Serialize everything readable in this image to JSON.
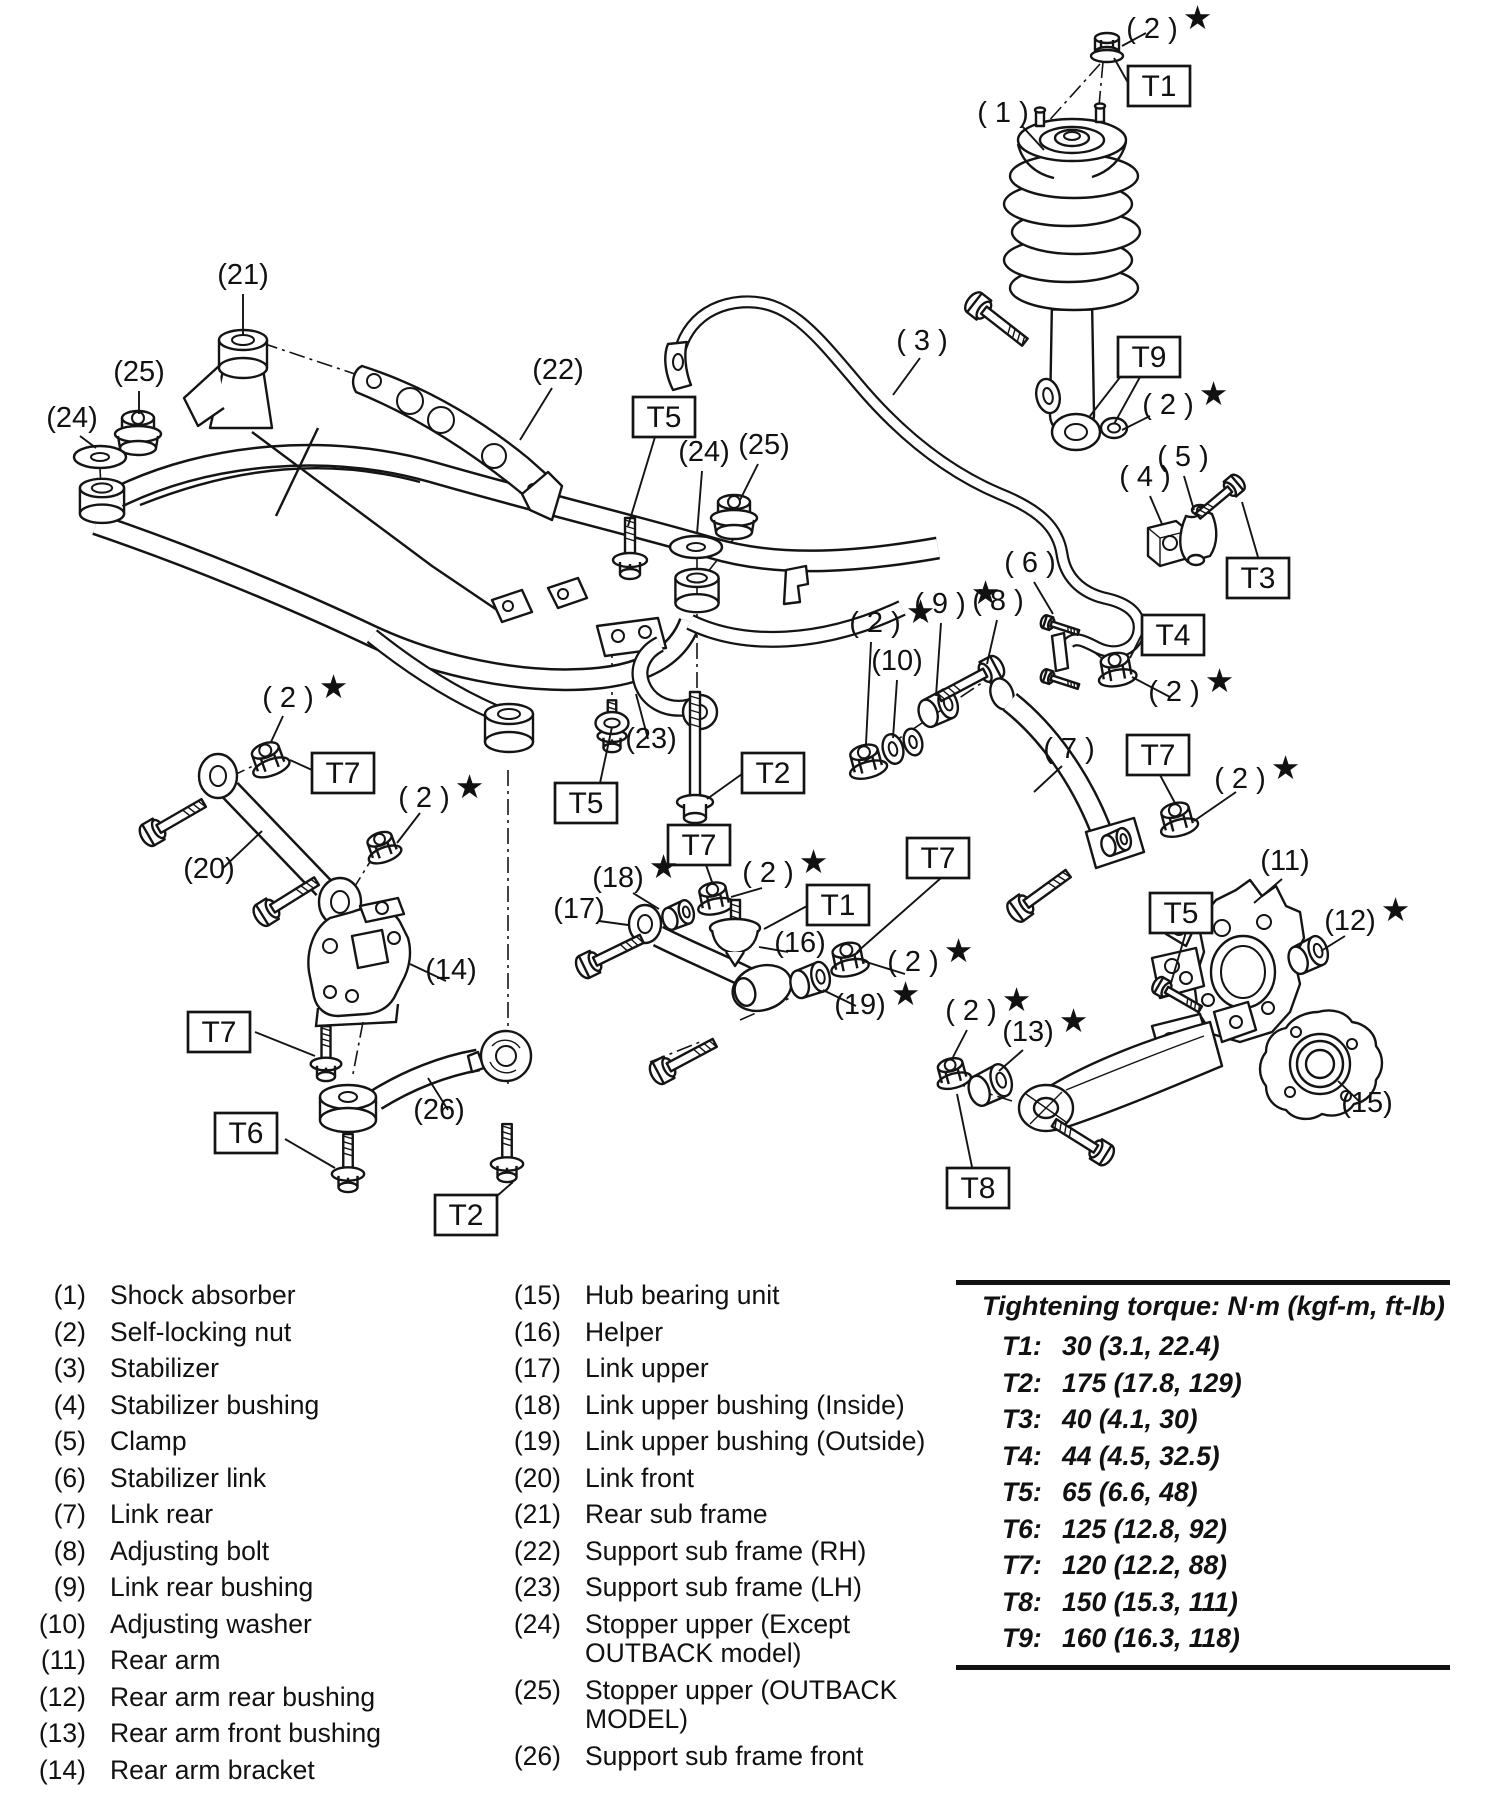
{
  "diagram": {
    "star": "★",
    "callouts": [
      {
        "t": "( 2 )",
        "x": 1152,
        "y": 38,
        "s": true
      },
      {
        "t": "( 1 )",
        "x": 1003,
        "y": 122,
        "s": false
      },
      {
        "t": "( 3 )",
        "x": 922,
        "y": 350,
        "s": false
      },
      {
        "t": "( 2 )",
        "x": 1168,
        "y": 414,
        "s": true
      },
      {
        "t": "(21)",
        "x": 243,
        "y": 284,
        "s": false
      },
      {
        "t": "(25)",
        "x": 139,
        "y": 381,
        "s": false
      },
      {
        "t": "(24)",
        "x": 72,
        "y": 427,
        "s": false
      },
      {
        "t": "(22)",
        "x": 558,
        "y": 379,
        "s": false
      },
      {
        "t": "(24)",
        "x": 704,
        "y": 461,
        "s": false
      },
      {
        "t": "(25)",
        "x": 764,
        "y": 454,
        "s": false
      },
      {
        "t": "( 4 )",
        "x": 1145,
        "y": 486,
        "s": false
      },
      {
        "t": "( 5 )",
        "x": 1183,
        "y": 466,
        "s": false
      },
      {
        "t": "( 6 )",
        "x": 1030,
        "y": 572,
        "s": false
      },
      {
        "t": "( 9 )",
        "x": 940,
        "y": 613,
        "s": true
      },
      {
        "t": "( 8 )",
        "x": 998,
        "y": 610,
        "s": false
      },
      {
        "t": "( 2 )",
        "x": 875,
        "y": 632,
        "s": true
      },
      {
        "t": "(10)",
        "x": 897,
        "y": 670,
        "s": false
      },
      {
        "t": "( 2 )",
        "x": 1174,
        "y": 701,
        "s": true
      },
      {
        "t": "( 7 )",
        "x": 1069,
        "y": 758,
        "s": false
      },
      {
        "t": "( 2 )",
        "x": 1240,
        "y": 788,
        "s": true
      },
      {
        "t": "( 2 )",
        "x": 288,
        "y": 707,
        "s": true
      },
      {
        "t": "( 2 )",
        "x": 424,
        "y": 807,
        "s": true
      },
      {
        "t": "(20)",
        "x": 209,
        "y": 878,
        "s": false
      },
      {
        "t": "(23)",
        "x": 651,
        "y": 748,
        "s": false
      },
      {
        "t": "(18)",
        "x": 618,
        "y": 887,
        "s": true
      },
      {
        "t": "( 2 )",
        "x": 768,
        "y": 882,
        "s": true
      },
      {
        "t": "(17)",
        "x": 579,
        "y": 918,
        "s": false
      },
      {
        "t": "(16)",
        "x": 800,
        "y": 952,
        "s": false
      },
      {
        "t": "( 2 )",
        "x": 913,
        "y": 971,
        "s": true
      },
      {
        "t": "(19)",
        "x": 860,
        "y": 1014,
        "s": true
      },
      {
        "t": "(11)",
        "x": 1285,
        "y": 870,
        "s": false
      },
      {
        "t": "(12)",
        "x": 1350,
        "y": 930,
        "s": true
      },
      {
        "t": "(14)",
        "x": 451,
        "y": 979,
        "s": false
      },
      {
        "t": "( 2 )",
        "x": 971,
        "y": 1020,
        "s": true
      },
      {
        "t": "(13)",
        "x": 1028,
        "y": 1041,
        "s": true
      },
      {
        "t": "(15)",
        "x": 1367,
        "y": 1112,
        "s": false
      },
      {
        "t": "(26)",
        "x": 439,
        "y": 1119,
        "s": false
      }
    ],
    "torque_boxes": [
      {
        "label": "T1",
        "x": 1128,
        "y": 66
      },
      {
        "label": "T9",
        "x": 1118,
        "y": 337
      },
      {
        "label": "T5",
        "x": 633,
        "y": 397
      },
      {
        "label": "T3",
        "x": 1227,
        "y": 558
      },
      {
        "label": "T4",
        "x": 1142,
        "y": 615
      },
      {
        "label": "T7",
        "x": 1127,
        "y": 735
      },
      {
        "label": "T7",
        "x": 312,
        "y": 753
      },
      {
        "label": "T5",
        "x": 555,
        "y": 783
      },
      {
        "label": "T2",
        "x": 742,
        "y": 753
      },
      {
        "label": "T7",
        "x": 668,
        "y": 825
      },
      {
        "label": "T1",
        "x": 807,
        "y": 885
      },
      {
        "label": "T7",
        "x": 907,
        "y": 838
      },
      {
        "label": "T5",
        "x": 1150,
        "y": 893
      },
      {
        "label": "T7",
        "x": 188,
        "y": 1012
      },
      {
        "label": "T6",
        "x": 215,
        "y": 1113
      },
      {
        "label": "T2",
        "x": 435,
        "y": 1195
      },
      {
        "label": "T8",
        "x": 947,
        "y": 1168
      }
    ]
  },
  "legend": {
    "left": [
      {
        "num": "(1)",
        "label": "Shock absorber"
      },
      {
        "num": "(2)",
        "label": "Self-locking nut"
      },
      {
        "num": "(3)",
        "label": "Stabilizer"
      },
      {
        "num": "(4)",
        "label": "Stabilizer bushing"
      },
      {
        "num": "(5)",
        "label": "Clamp"
      },
      {
        "num": "(6)",
        "label": "Stabilizer link"
      },
      {
        "num": "(7)",
        "label": "Link rear"
      },
      {
        "num": "(8)",
        "label": "Adjusting bolt"
      },
      {
        "num": "(9)",
        "label": "Link rear bushing"
      },
      {
        "num": "(10)",
        "label": "Adjusting washer"
      },
      {
        "num": "(11)",
        "label": "Rear arm"
      },
      {
        "num": "(12)",
        "label": "Rear arm rear bushing"
      },
      {
        "num": "(13)",
        "label": "Rear arm front bushing"
      },
      {
        "num": "(14)",
        "label": "Rear arm bracket"
      }
    ],
    "right": [
      {
        "num": "(15)",
        "label": "Hub bearing unit"
      },
      {
        "num": "(16)",
        "label": "Helper"
      },
      {
        "num": "(17)",
        "label": "Link upper"
      },
      {
        "num": "(18)",
        "label": "Link upper bushing (Inside)"
      },
      {
        "num": "(19)",
        "label": "Link upper bushing (Outside)"
      },
      {
        "num": "(20)",
        "label": "Link front"
      },
      {
        "num": "(21)",
        "label": "Rear sub frame"
      },
      {
        "num": "(22)",
        "label": "Support sub frame (RH)"
      },
      {
        "num": "(23)",
        "label": "Support sub frame (LH)"
      },
      {
        "num": "(24)",
        "label": "Stopper upper (Except OUTBACK model)"
      },
      {
        "num": "(25)",
        "label": "Stopper upper (OUTBACK MODEL)"
      },
      {
        "num": "(26)",
        "label": "Support sub frame front"
      }
    ]
  },
  "torque_table": {
    "title": "Tightening torque: N·m (kgf-m, ft-lb)",
    "rows": [
      {
        "id": "T1:",
        "value": "30 (3.1, 22.4)"
      },
      {
        "id": "T2:",
        "value": "175 (17.8, 129)"
      },
      {
        "id": "T3:",
        "value": "40 (4.1, 30)"
      },
      {
        "id": "T4:",
        "value": "44 (4.5, 32.5)"
      },
      {
        "id": "T5:",
        "value": "65 (6.6, 48)"
      },
      {
        "id": "T6:",
        "value": "125 (12.8, 92)"
      },
      {
        "id": "T7:",
        "value": "120 (12.2, 88)"
      },
      {
        "id": "T8:",
        "value": "150 (15.3, 111)"
      },
      {
        "id": "T9:",
        "value": "160 (16.3, 118)"
      }
    ]
  }
}
